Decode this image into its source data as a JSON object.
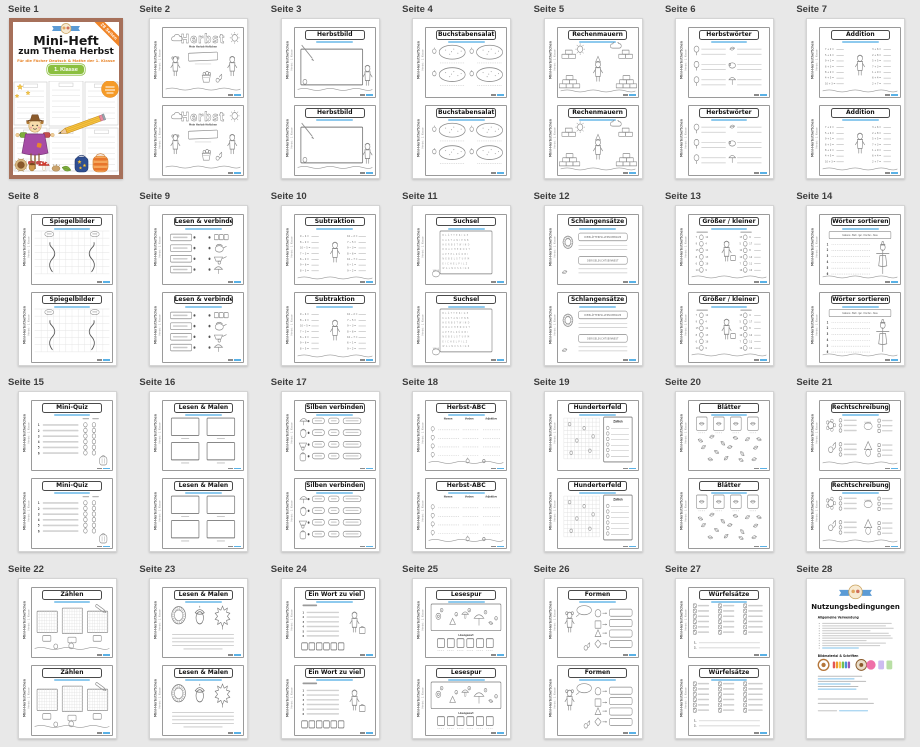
{
  "background_color": "#e8e8e8",
  "accent_blue": "#59b1e6",
  "cover": {
    "title_line1": "Mini-Heft",
    "title_line2": "zum Thema Herbst",
    "subtitle": "Für die Fächer Deutsch & Mathe der 1. Klasse",
    "badge": "1. Klasse",
    "ribbon": "28 Seiten"
  },
  "mini_page": {
    "side_text": "Mini-Herbstheftchen",
    "side_subtext": "Herbst · 1. Klasse"
  },
  "widgets": {
    "herbst_subtitle": "Mein Herbst-Heftchen",
    "zahlen_header": "Zahlen",
    "loesungswort": "Lösungswort",
    "abc_columns": [
      "Nomen",
      "Verben",
      "Adjektive"
    ]
  },
  "terms": {
    "title": "Nutzungsbedingungen",
    "section1": "Allgemeine Verwendung",
    "section2": "Bildmaterial & Schriften"
  },
  "pages": [
    {
      "label": "Seite 1",
      "title": "",
      "type": "cover"
    },
    {
      "label": "Seite 2",
      "title": "Herbst",
      "type": "herbst"
    },
    {
      "label": "Seite 3",
      "title": "Herbstbild",
      "type": "board"
    },
    {
      "label": "Seite 4",
      "title": "Buchstabensalat",
      "type": "salat"
    },
    {
      "label": "Seite 5",
      "title": "Rechenmauern",
      "type": "mauern"
    },
    {
      "label": "Seite 6",
      "title": "Herbstwörter",
      "type": "woerter"
    },
    {
      "label": "Seite 7",
      "title": "Addition",
      "type": "add"
    },
    {
      "label": "Seite 8",
      "title": "Spiegelbilder",
      "type": "spiegel"
    },
    {
      "label": "Seite 9",
      "title": "Lesen & verbinden",
      "type": "verbinden"
    },
    {
      "label": "Seite 10",
      "title": "Subtraktion",
      "type": "sub"
    },
    {
      "label": "Seite 11",
      "title": "Suchsel",
      "type": "suchsel"
    },
    {
      "label": "Seite 12",
      "title": "Schlangensätze",
      "type": "schlangen"
    },
    {
      "label": "Seite 13",
      "title": "Größer / kleiner",
      "type": "groesser"
    },
    {
      "label": "Seite 14",
      "title": "Wörter sortieren",
      "type": "sortieren"
    },
    {
      "label": "Seite 15",
      "title": "Mini-Quiz",
      "type": "quiz"
    },
    {
      "label": "Seite 16",
      "title": "Lesen & Malen",
      "type": "boxes"
    },
    {
      "label": "Seite 17",
      "title": "Silben verbinden",
      "type": "silben"
    },
    {
      "label": "Seite 18",
      "title": "Herbst-ABC",
      "type": "abc"
    },
    {
      "label": "Seite 19",
      "title": "Hunderterfeld",
      "type": "hundert"
    },
    {
      "label": "Seite 20",
      "title": "Blätter",
      "type": "blaetter"
    },
    {
      "label": "Seite 21",
      "title": "Rechtschreibung",
      "type": "recht"
    },
    {
      "label": "Seite 22",
      "title": "Zählen",
      "type": "zaehlen"
    },
    {
      "label": "Seite 23",
      "title": "Lesen & Malen",
      "type": "lesen2"
    },
    {
      "label": "Seite 24",
      "title": "Ein Wort zu viel",
      "type": "wort"
    },
    {
      "label": "Seite 25",
      "title": "Lesespur",
      "type": "spur"
    },
    {
      "label": "Seite 26",
      "title": "Formen",
      "type": "formen"
    },
    {
      "label": "Seite 27",
      "title": "Würfelsätze",
      "type": "wuerfel"
    },
    {
      "label": "Seite 28",
      "title": "Nutzungsbedingungen",
      "type": "terms"
    }
  ]
}
